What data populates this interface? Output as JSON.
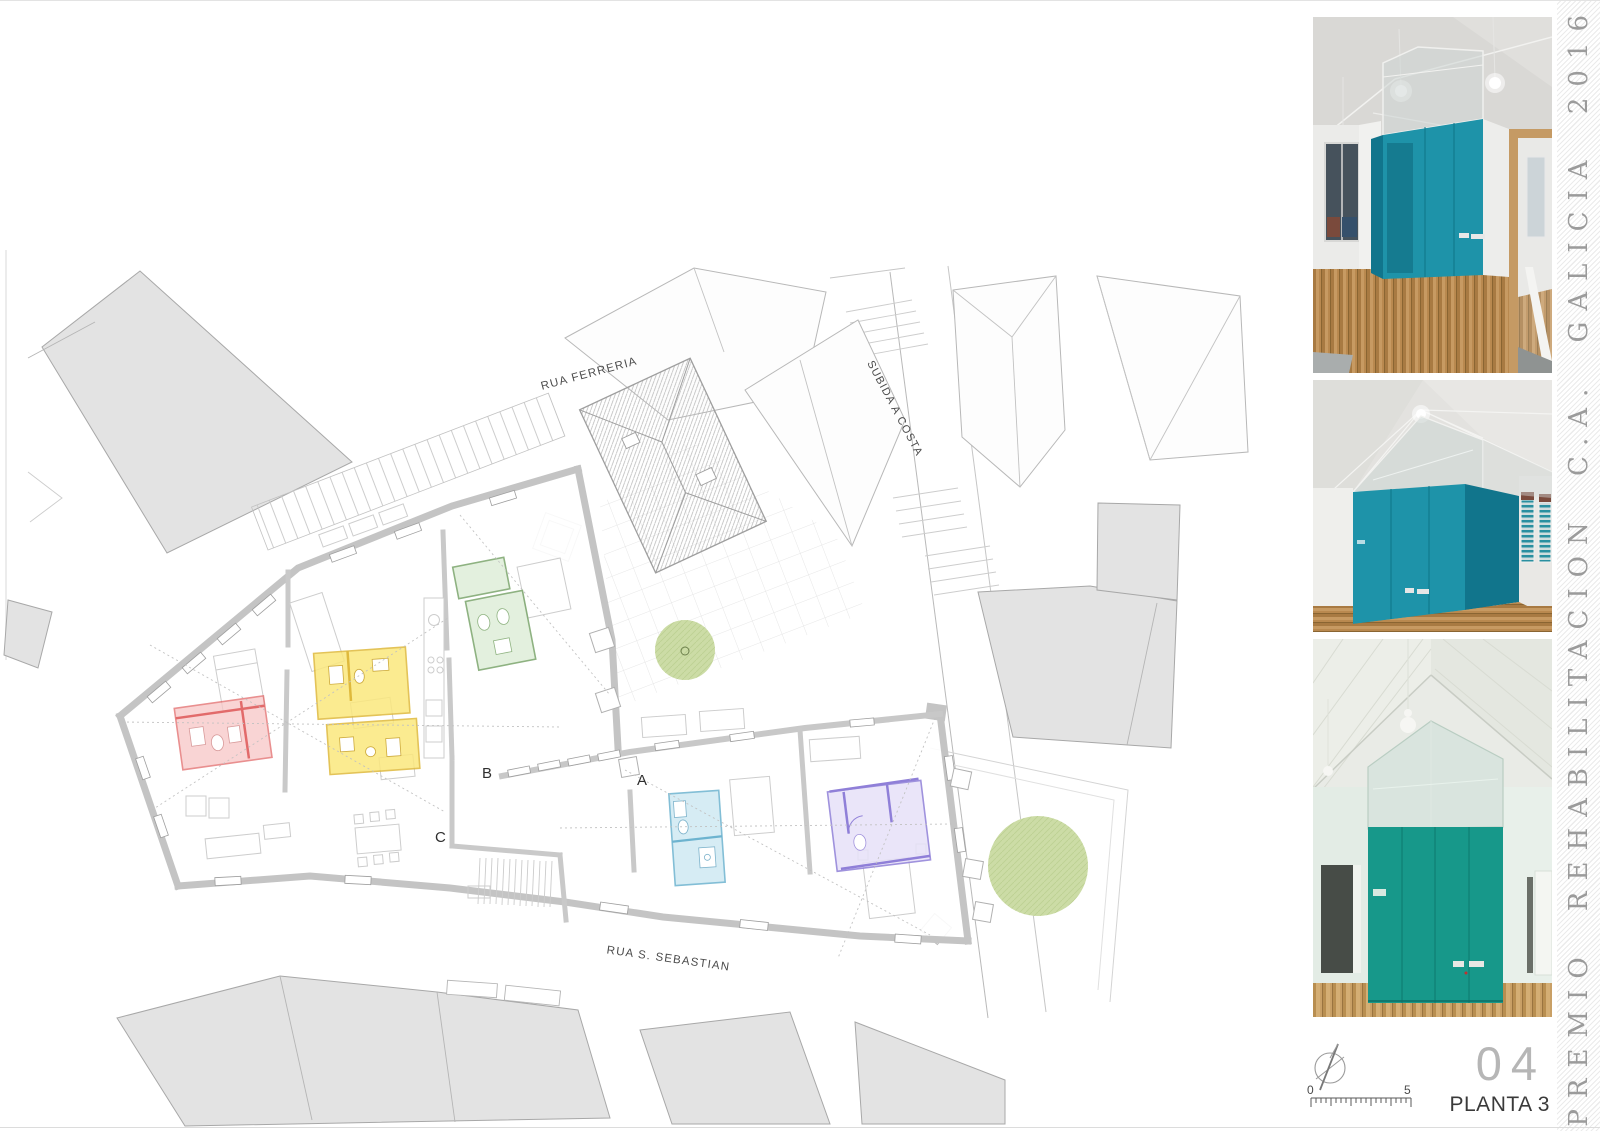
{
  "sheet": {
    "title_vertical": "PREMIO REHABILITACION C.A. GALICIA 2016",
    "sheet_number": "04",
    "sheet_title": "PLANTA 3",
    "scale_start": "0",
    "scale_end": "5"
  },
  "plan": {
    "street_top": "RUA FERRERIA",
    "street_right": "SUBIDA A COSTA",
    "street_bottom": "RUA S. SEBASTIAN",
    "section_a": "A",
    "section_b": "B",
    "section_c": "C",
    "colors": {
      "wall": "#c4c4c4",
      "red_room": "#f7c6c6",
      "red_line": "#e26a6a",
      "yellow_room": "#fbe87d",
      "yellow_line": "#dfb93c",
      "green_room": "#e1efdb",
      "green_line": "#82aa74",
      "blue_room": "#cfe9f3",
      "blue_line": "#6db3cf",
      "purple_room": "#e7e1f8",
      "purple_line": "#8f7fd8",
      "tree": "#ccdca6"
    }
  },
  "photos": {
    "teal_front": "#1e93a9",
    "teal_side": "#11758c",
    "teal_green": "#17988a",
    "teal_green_dark": "#0f7f73",
    "items": [
      {
        "name": "interior-photo-corridor-teal-volume"
      },
      {
        "name": "interior-photo-teal-volume-glass-gable"
      },
      {
        "name": "interior-photo-teal-volume-frontal"
      }
    ]
  }
}
